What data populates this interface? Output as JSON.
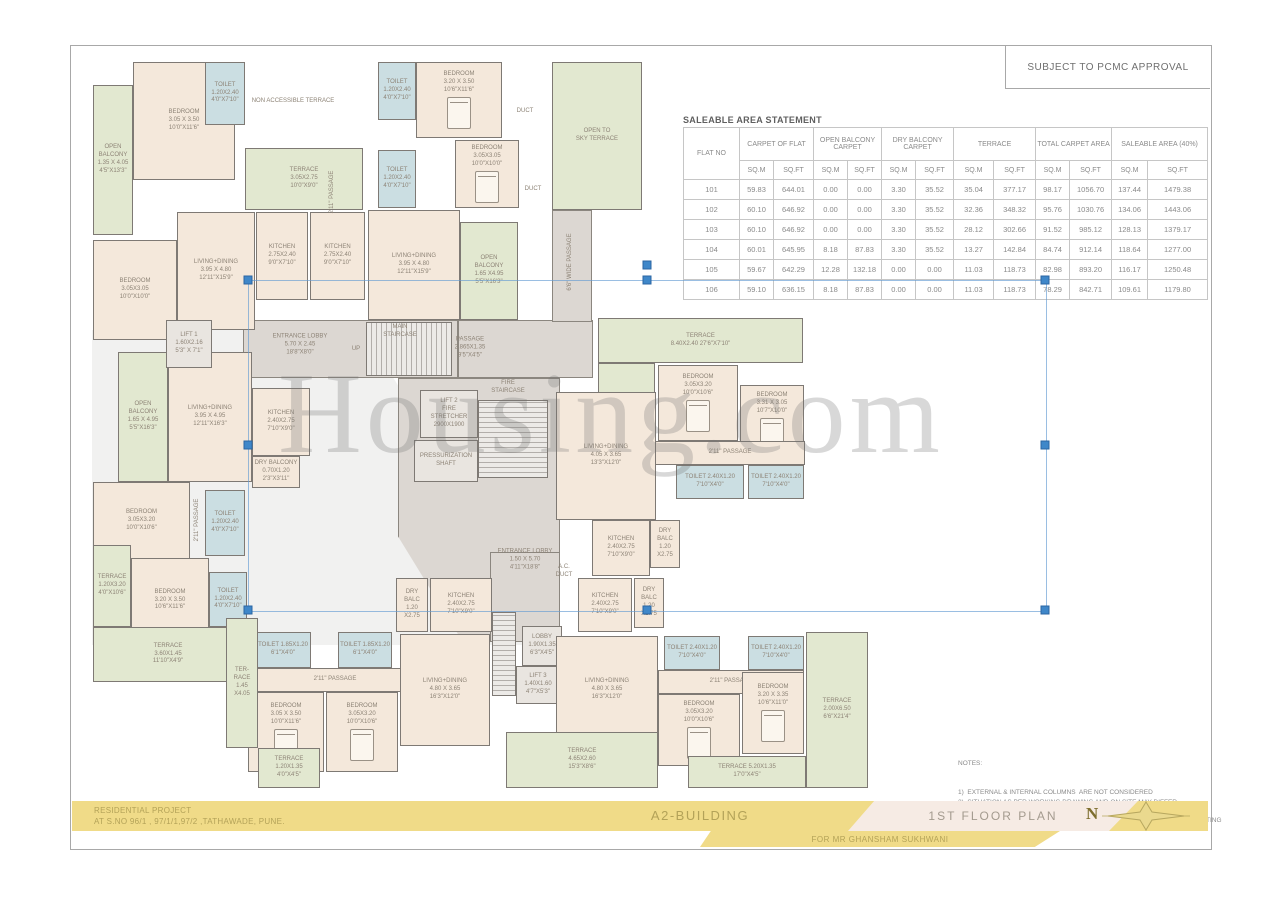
{
  "page": {
    "approval_note": "SUBJECT TO PCMC APPROVAL",
    "watermark": "Housing.com"
  },
  "table": {
    "title": "SALEABLE AREA STATEMENT",
    "col_groups": [
      {
        "label": "FLAT NO"
      },
      {
        "label": "CARPET OF FLAT"
      },
      {
        "label": "OPEN BALCONY CARPET"
      },
      {
        "label": "DRY BALCONY CARPET"
      },
      {
        "label": "TERRACE"
      },
      {
        "label": "TOTAL CARPET AREA"
      },
      {
        "label": "SALEABLE AREA (40%)"
      }
    ],
    "units": [
      "SQ.M",
      "SQ.FT"
    ],
    "rows": [
      [
        "101",
        "59.83",
        "644.01",
        "0.00",
        "0.00",
        "3.30",
        "35.52",
        "35.04",
        "377.17",
        "98.17",
        "1056.70",
        "137.44",
        "1479.38"
      ],
      [
        "102",
        "60.10",
        "646.92",
        "0.00",
        "0.00",
        "3.30",
        "35.52",
        "32.36",
        "348.32",
        "95.76",
        "1030.76",
        "134.06",
        "1443.06"
      ],
      [
        "103",
        "60.10",
        "646.92",
        "0.00",
        "0.00",
        "3.30",
        "35.52",
        "28.12",
        "302.66",
        "91.52",
        "985.12",
        "128.13",
        "1379.17"
      ],
      [
        "104",
        "60.01",
        "645.95",
        "8.18",
        "87.83",
        "3.30",
        "35.52",
        "13.27",
        "142.84",
        "84.74",
        "912.14",
        "118.64",
        "1277.00"
      ],
      [
        "105",
        "59.67",
        "642.29",
        "12.28",
        "132.18",
        "0.00",
        "0.00",
        "11.03",
        "118.73",
        "82.98",
        "893.20",
        "116.17",
        "1250.48"
      ],
      [
        "106",
        "59.10",
        "636.15",
        "8.18",
        "87.83",
        "0.00",
        "0.00",
        "11.03",
        "118.73",
        "78.29",
        "842.71",
        "109.61",
        "1179.80"
      ]
    ]
  },
  "notes": {
    "heading": "NOTES:",
    "lines": [
      "1)  EXTERNAL & INTERNAL COLUMNS  ARE NOT CONSIDERED",
      "2)  SITUATION AS PER WORKING DRAWING AND ON SITE MAY DIFFER",
      "3)  THICKNESS OF EXTERNAL & INTERNAL WALLS IS CONSIDERED",
      "      WITHOUT THICKNESS OF EXTERNAL & INTERNAL PLASTER, DADO,      SKIRTING",
      "4) DUE TO STRUCTURE RCC COLUMNS / SHEAR WALLS  THE DIMENSIONS",
      "     MAY VARY AS COMPARED WITH SANCTIONED MUNICIPAL DRAWINGS"
    ]
  },
  "title_block": {
    "project_line1": "RESIDENTIAL PROJECT",
    "project_line2": "AT S.NO 96/1 , 97/1/1,97/2 ,TATHAWADE, PUNE.",
    "building": "A2-BUILDING",
    "plan_title": "1ST FLOOR PLAN",
    "client": "FOR MR GHANSHAM SUKHWANI",
    "north_label": "N"
  },
  "selection": {
    "x": 248,
    "y": 280,
    "w": 797,
    "h": 330,
    "rotation_handle_y": 265
  },
  "plan": {
    "zones": [
      {
        "n": "shade",
        "t": "shade",
        "x": 92,
        "y": 330,
        "w": 468,
        "h": 315,
        "clip": "polygon(0 0,58% 0,100% 100%,0 100%)"
      },
      {
        "n": "lobby-corridor",
        "t": "gray",
        "x": 243,
        "y": 320,
        "w": 215,
        "h": 58
      },
      {
        "n": "upper-passage",
        "t": "gray",
        "x": 458,
        "y": 320,
        "w": 135,
        "h": 58
      },
      {
        "n": "side-passage",
        "t": "gray",
        "x": 552,
        "y": 210,
        "w": 40,
        "h": 112
      },
      {
        "n": "core",
        "t": "gray",
        "x": 398,
        "y": 378,
        "w": 162,
        "h": 264,
        "clip": "polygon(0 0,100% 0,100% 100%,40% 100%,0 60%)"
      },
      {
        "n": "entrance-lobby-2",
        "t": "gray",
        "x": 490,
        "y": 552,
        "w": 70,
        "h": 90
      }
    ],
    "rooms": [
      {
        "n": "open-balcony",
        "t": "green",
        "x": 93,
        "y": 85,
        "w": 40,
        "h": 150,
        "l": [
          "OPEN",
          "BALCONY",
          "1.35 X 4.05",
          "4'5\"X13'3\""
        ]
      },
      {
        "n": "bedroom",
        "t": "cream",
        "x": 133,
        "y": 62,
        "w": 102,
        "h": 118,
        "l": [
          "BEDROOM",
          "3.05 X 3.50",
          "10'0\"X11'6\""
        ]
      },
      {
        "n": "toilet",
        "t": "blue",
        "x": 205,
        "y": 62,
        "w": 40,
        "h": 63,
        "l": [
          "TOILET",
          "1.20X2.40",
          "4'0\"X7'10\""
        ]
      },
      {
        "n": "terrace",
        "t": "green",
        "x": 245,
        "y": 148,
        "w": 118,
        "h": 62,
        "l": [
          "TERRACE",
          "3.05X2.75",
          "10'0\"X9'0\""
        ]
      },
      {
        "n": "bedroom",
        "t": "cream",
        "x": 93,
        "y": 240,
        "w": 84,
        "h": 100,
        "l": [
          "BEDROOM",
          "3.05X3.05",
          "10'0\"X10'0\""
        ]
      },
      {
        "n": "living-dining",
        "t": "cream",
        "x": 177,
        "y": 212,
        "w": 78,
        "h": 118,
        "l": [
          "LIVING+DINING",
          "3.95 X 4.80",
          "12'11\"X15'9\""
        ]
      },
      {
        "n": "kitchen",
        "t": "cream",
        "x": 256,
        "y": 212,
        "w": 52,
        "h": 88,
        "l": [
          "KITCHEN",
          "2.75X2.40",
          "9'0\"X7'10\""
        ]
      },
      {
        "n": "kitchen",
        "t": "cream",
        "x": 310,
        "y": 212,
        "w": 55,
        "h": 88,
        "l": [
          "KITCHEN",
          "2.75X2.40",
          "9'0\"X7'10\""
        ]
      },
      {
        "n": "open-balcony",
        "t": "green",
        "x": 118,
        "y": 352,
        "w": 50,
        "h": 130,
        "l": [
          "OPEN",
          "BALCONY",
          "1.65 X 4.95",
          "5'5\"X16'3\""
        ]
      },
      {
        "n": "living-dining",
        "t": "cream",
        "x": 168,
        "y": 352,
        "w": 84,
        "h": 130,
        "l": [
          "LIVING+DINING",
          "3.95 X 4.95",
          "12'11\"X16'3\""
        ]
      },
      {
        "n": "kitchen",
        "t": "cream",
        "x": 252,
        "y": 388,
        "w": 58,
        "h": 68,
        "l": [
          "KITCHEN",
          "2.40X2.75",
          "7'10\"X9'0\""
        ]
      },
      {
        "n": "dry-balcony",
        "t": "cream",
        "x": 252,
        "y": 456,
        "w": 48,
        "h": 32,
        "l": [
          "DRY BALCONY",
          "0.70X1.20",
          "2'3\"X3'11\""
        ]
      },
      {
        "n": "lift-1",
        "t": "graylight",
        "x": 166,
        "y": 320,
        "w": 46,
        "h": 48,
        "l": [
          "LIFT 1",
          "1.60X2.16",
          "5'3\" X 7'1\""
        ]
      },
      {
        "n": "bedroom",
        "t": "cream",
        "x": 93,
        "y": 482,
        "w": 97,
        "h": 78,
        "l": [
          "BEDROOM",
          "3.05X3.20",
          "10'0\"X10'6\""
        ]
      },
      {
        "n": "toilet",
        "t": "blue",
        "x": 205,
        "y": 490,
        "w": 40,
        "h": 66,
        "l": [
          "TOILET",
          "1.20X2.40",
          "4'0\"X7'10\""
        ]
      },
      {
        "n": "terrace",
        "t": "green",
        "x": 93,
        "y": 545,
        "w": 38,
        "h": 82,
        "l": [
          "TERRACE",
          "1.20X3.20",
          "4'0\"X10'6\""
        ]
      },
      {
        "n": "bedroom",
        "t": "cream",
        "x": 131,
        "y": 558,
        "w": 78,
        "h": 85,
        "l": [
          "BEDROOM",
          "3.20 X 3.50",
          "10'6\"X11'6\""
        ]
      },
      {
        "n": "toilet",
        "t": "blue",
        "x": 209,
        "y": 572,
        "w": 38,
        "h": 55,
        "l": [
          "TOILET",
          "1.20X2.40",
          "4'0\"X7'10\""
        ]
      },
      {
        "n": "terrace",
        "t": "green",
        "x": 93,
        "y": 627,
        "w": 150,
        "h": 55,
        "l": [
          "TERRACE",
          "3.60X1.45",
          "11'10\"X4'9\""
        ]
      },
      {
        "n": "toilet",
        "t": "blue",
        "x": 378,
        "y": 62,
        "w": 38,
        "h": 58,
        "l": [
          "TOILET",
          "1.20X2.40",
          "4'0\"X7'10\""
        ]
      },
      {
        "n": "bedroom",
        "t": "cream",
        "x": 416,
        "y": 62,
        "w": 86,
        "h": 76,
        "bed": 1,
        "l": [
          "BEDROOM",
          "3.20 X 3.50",
          "10'6\"X11'6\""
        ]
      },
      {
        "n": "bedroom",
        "t": "cream",
        "x": 455,
        "y": 140,
        "w": 64,
        "h": 68,
        "bed": 1,
        "l": [
          "BEDROOM",
          "3.05X3.05",
          "10'0\"X10'0\""
        ]
      },
      {
        "n": "toilet",
        "t": "blue",
        "x": 378,
        "y": 150,
        "w": 38,
        "h": 58,
        "l": [
          "TOILET",
          "1.20X2.40",
          "4'0\"X7'10\""
        ]
      },
      {
        "n": "living-dining",
        "t": "cream",
        "x": 368,
        "y": 210,
        "w": 92,
        "h": 110,
        "l": [
          "LIVING+DINING",
          "3.95 X 4.80",
          "12'11\"X15'9\""
        ]
      },
      {
        "n": "open-balcony",
        "t": "green",
        "x": 460,
        "y": 222,
        "w": 58,
        "h": 98,
        "l": [
          "OPEN",
          "BALCONY",
          "1.65 X4.95",
          "5'5\"X16'3\""
        ]
      },
      {
        "n": "open-to-sky-terrace",
        "t": "green",
        "x": 552,
        "y": 62,
        "w": 90,
        "h": 148,
        "l": [
          "OPEN TO",
          "SKY TERRACE"
        ]
      },
      {
        "n": "main-staircase",
        "t": "stairsv",
        "x": 366,
        "y": 322,
        "w": 86,
        "h": 54,
        "l": []
      },
      {
        "n": "lift-2",
        "t": "graylight",
        "x": 420,
        "y": 390,
        "w": 58,
        "h": 48,
        "l": [
          "LIFT 2",
          "FIRE",
          "STRETCHER",
          "2900X1900"
        ]
      },
      {
        "n": "fire-staircase",
        "t": "stairsh",
        "x": 478,
        "y": 400,
        "w": 70,
        "h": 78,
        "l": []
      },
      {
        "n": "pressurization-shaft",
        "t": "graylight",
        "x": 414,
        "y": 440,
        "w": 64,
        "h": 42,
        "l": [
          "PRESSURIZATION",
          "SHAFT"
        ]
      },
      {
        "n": "stair-3",
        "t": "stairsh",
        "x": 492,
        "y": 612,
        "w": 24,
        "h": 84,
        "l": []
      },
      {
        "n": "lobby",
        "t": "graylight",
        "x": 522,
        "y": 626,
        "w": 40,
        "h": 40,
        "l": [
          "LOBBY",
          "1.90X1.35",
          "6'3\"X4'5\""
        ]
      },
      {
        "n": "lift-3",
        "t": "graylight",
        "x": 516,
        "y": 666,
        "w": 44,
        "h": 38,
        "l": [
          "LIFT 3",
          "1.40X1.60",
          "4'7\"X5'3\""
        ]
      },
      {
        "n": "terrace",
        "t": "green",
        "x": 598,
        "y": 318,
        "w": 205,
        "h": 45,
        "l": [
          "TERRACE",
          "8.40X2.40  27'6\"X7'10\""
        ]
      },
      {
        "n": "terrace",
        "t": "green",
        "x": 598,
        "y": 363,
        "w": 57,
        "h": 92,
        "l": [
          "TERRACE",
          "4.95 X 2.30",
          "16'3\"X7'7\""
        ]
      },
      {
        "n": "bedroom",
        "t": "cream",
        "x": 658,
        "y": 365,
        "w": 80,
        "h": 76,
        "bed": 1,
        "l": [
          "BEDROOM",
          "3.05X3.20",
          "10'0\"X10'6\""
        ]
      },
      {
        "n": "bedroom",
        "t": "cream",
        "x": 740,
        "y": 385,
        "w": 64,
        "h": 72,
        "bed": 1,
        "l": [
          "BEDROOM",
          "3.31 X 3.05",
          "10'7\"X10'0\""
        ]
      },
      {
        "n": "passage",
        "t": "cream",
        "x": 655,
        "y": 441,
        "w": 150,
        "h": 24,
        "l": [
          "2'11\" PASSAGE"
        ]
      },
      {
        "n": "toilet",
        "t": "blue",
        "x": 676,
        "y": 465,
        "w": 68,
        "h": 34,
        "l": [
          "TOILET 2.40X1.20",
          "7'10\"X4'0\""
        ]
      },
      {
        "n": "toilet",
        "t": "blue",
        "x": 748,
        "y": 465,
        "w": 56,
        "h": 34,
        "l": [
          "TOILET 2.40X1.20",
          "7'10\"X4'0\""
        ]
      },
      {
        "n": "living-dining",
        "t": "cream",
        "x": 556,
        "y": 392,
        "w": 100,
        "h": 128,
        "l": [
          "LIVING+DINING",
          "4.05 X 3.65",
          "13'3\"X12'0\""
        ]
      },
      {
        "n": "kitchen",
        "t": "cream",
        "x": 592,
        "y": 520,
        "w": 58,
        "h": 56,
        "l": [
          "KITCHEN",
          "2.40X2.75",
          "7'10\"X9'0\""
        ]
      },
      {
        "n": "dry-balcony",
        "t": "cream",
        "x": 650,
        "y": 520,
        "w": 30,
        "h": 48,
        "l": [
          "DRY",
          "BALC",
          "1.20",
          "X2.75"
        ]
      },
      {
        "n": "kitchen",
        "t": "cream",
        "x": 578,
        "y": 578,
        "w": 54,
        "h": 54,
        "l": [
          "KITCHEN",
          "2.40X2.75",
          "7'10\"X9'0\""
        ]
      },
      {
        "n": "dry-balcony",
        "t": "cream",
        "x": 634,
        "y": 578,
        "w": 30,
        "h": 50,
        "l": [
          "DRY",
          "BALC",
          "1.20",
          "X2.75"
        ]
      },
      {
        "n": "living-dining",
        "t": "cream",
        "x": 556,
        "y": 636,
        "w": 102,
        "h": 108,
        "l": [
          "LIVING+DINING",
          "4.80 X 3.65",
          "16'3\"X12'0\""
        ]
      },
      {
        "n": "toilet",
        "t": "blue",
        "x": 664,
        "y": 636,
        "w": 56,
        "h": 34,
        "l": [
          "TOILET 2.40X1.20",
          "7'10\"X4'0\""
        ]
      },
      {
        "n": "toilet",
        "t": "blue",
        "x": 748,
        "y": 636,
        "w": 56,
        "h": 34,
        "l": [
          "TOILET 2.40X1.20",
          "7'10\"X4'0\""
        ]
      },
      {
        "n": "passage",
        "t": "cream",
        "x": 658,
        "y": 670,
        "w": 146,
        "h": 24,
        "l": [
          "2'11\" PASSAGE"
        ]
      },
      {
        "n": "bedroom",
        "t": "cream",
        "x": 658,
        "y": 694,
        "w": 82,
        "h": 72,
        "bed": 1,
        "l": [
          "BEDROOM",
          "3.05X3.20",
          "10'0\"X10'6\""
        ]
      },
      {
        "n": "bedroom",
        "t": "cream",
        "x": 742,
        "y": 672,
        "w": 62,
        "h": 82,
        "bed": 1,
        "l": [
          "BEDROOM",
          "3.20 X 3.35",
          "10'6\"X11'0\""
        ]
      },
      {
        "n": "terrace",
        "t": "green",
        "x": 806,
        "y": 632,
        "w": 62,
        "h": 156,
        "l": [
          "TERRACE",
          "2.00X6.50",
          "6'6\"X21'4\""
        ]
      },
      {
        "n": "terrace",
        "t": "green",
        "x": 688,
        "y": 756,
        "w": 118,
        "h": 32,
        "l": [
          "TERRACE 5.20X1.35",
          "17'0\"X4'5\""
        ]
      },
      {
        "n": "terrace",
        "t": "green",
        "x": 506,
        "y": 732,
        "w": 152,
        "h": 56,
        "l": [
          "TERRACE",
          "4.65X2.60",
          "15'3\"X8'6\""
        ]
      },
      {
        "n": "toilet",
        "t": "blue",
        "x": 255,
        "y": 632,
        "w": 56,
        "h": 36,
        "l": [
          "TOILET 1.85X1.20",
          "6'1\"X4'0\""
        ]
      },
      {
        "n": "toilet",
        "t": "blue",
        "x": 338,
        "y": 632,
        "w": 54,
        "h": 36,
        "l": [
          "TOILET 1.85X1.20",
          "6'1\"X4'0\""
        ]
      },
      {
        "n": "passage",
        "t": "cream",
        "x": 250,
        "y": 668,
        "w": 170,
        "h": 24,
        "l": [
          "2'11\" PASSAGE"
        ]
      },
      {
        "n": "bedroom",
        "t": "cream",
        "x": 248,
        "y": 692,
        "w": 76,
        "h": 80,
        "bed": 1,
        "l": [
          "BEDROOM",
          "3.05 X 3.50",
          "10'0\"X11'6\""
        ]
      },
      {
        "n": "bedroom",
        "t": "cream",
        "x": 326,
        "y": 692,
        "w": 72,
        "h": 80,
        "bed": 1,
        "l": [
          "BEDROOM",
          "3.05X3.20",
          "10'0\"X10'6\""
        ]
      },
      {
        "n": "dry-balcony",
        "t": "cream",
        "x": 396,
        "y": 578,
        "w": 32,
        "h": 54,
        "l": [
          "DRY",
          "BALC",
          "1.20",
          "X2.75"
        ]
      },
      {
        "n": "kitchen",
        "t": "cream",
        "x": 430,
        "y": 578,
        "w": 62,
        "h": 54,
        "l": [
          "KITCHEN",
          "2.40X2.75",
          "7'10\"X9'0\""
        ]
      },
      {
        "n": "living-dining",
        "t": "cream",
        "x": 400,
        "y": 634,
        "w": 90,
        "h": 112,
        "l": [
          "LIVING+DINING",
          "4.80 X 3.65",
          "16'3\"X12'0\""
        ]
      },
      {
        "n": "terrace",
        "t": "green",
        "x": 226,
        "y": 618,
        "w": 32,
        "h": 130,
        "l": [
          "TER-",
          "RACE",
          "1.45",
          "X4.05"
        ]
      },
      {
        "n": "terrace",
        "t": "green",
        "x": 258,
        "y": 748,
        "w": 62,
        "h": 40,
        "l": [
          "TERRACE",
          "1.20X1.35",
          "4'0\"X4'5\""
        ]
      }
    ],
    "texts": [
      {
        "x": 293,
        "y": 102,
        "s": "NON ACCESSIBLE TERRACE"
      },
      {
        "x": 333,
        "y": 192,
        "s": "2'11\" PASSAGE",
        "v": 1
      },
      {
        "x": 525,
        "y": 112,
        "s": "DUCT"
      },
      {
        "x": 533,
        "y": 190,
        "s": "DUCT"
      },
      {
        "x": 571,
        "y": 262,
        "s": "6'6\" WIDE PASSAGE",
        "v": 1
      },
      {
        "x": 300,
        "y": 345,
        "s": "ENTRANCE LOBBY\n5.70 X 2.45\n18'8\"X8'0\""
      },
      {
        "x": 400,
        "y": 332,
        "s": "MAIN\nSTAIRCASE"
      },
      {
        "x": 356,
        "y": 350,
        "s": "UP"
      },
      {
        "x": 470,
        "y": 348,
        "s": "PASSAGE\n2.865X1.35\n9'5\"X4'5\""
      },
      {
        "x": 508,
        "y": 388,
        "s": "FIRE\nSTAIRCASE"
      },
      {
        "x": 198,
        "y": 520,
        "s": "2'11\" PASSAGE",
        "v": 1
      },
      {
        "x": 564,
        "y": 572,
        "s": "A.C.\nDUCT"
      },
      {
        "x": 525,
        "y": 560,
        "s": "ENTRANCE LOBBY\n1.50 X 5.70\n4'11\"X18'8\""
      }
    ]
  }
}
